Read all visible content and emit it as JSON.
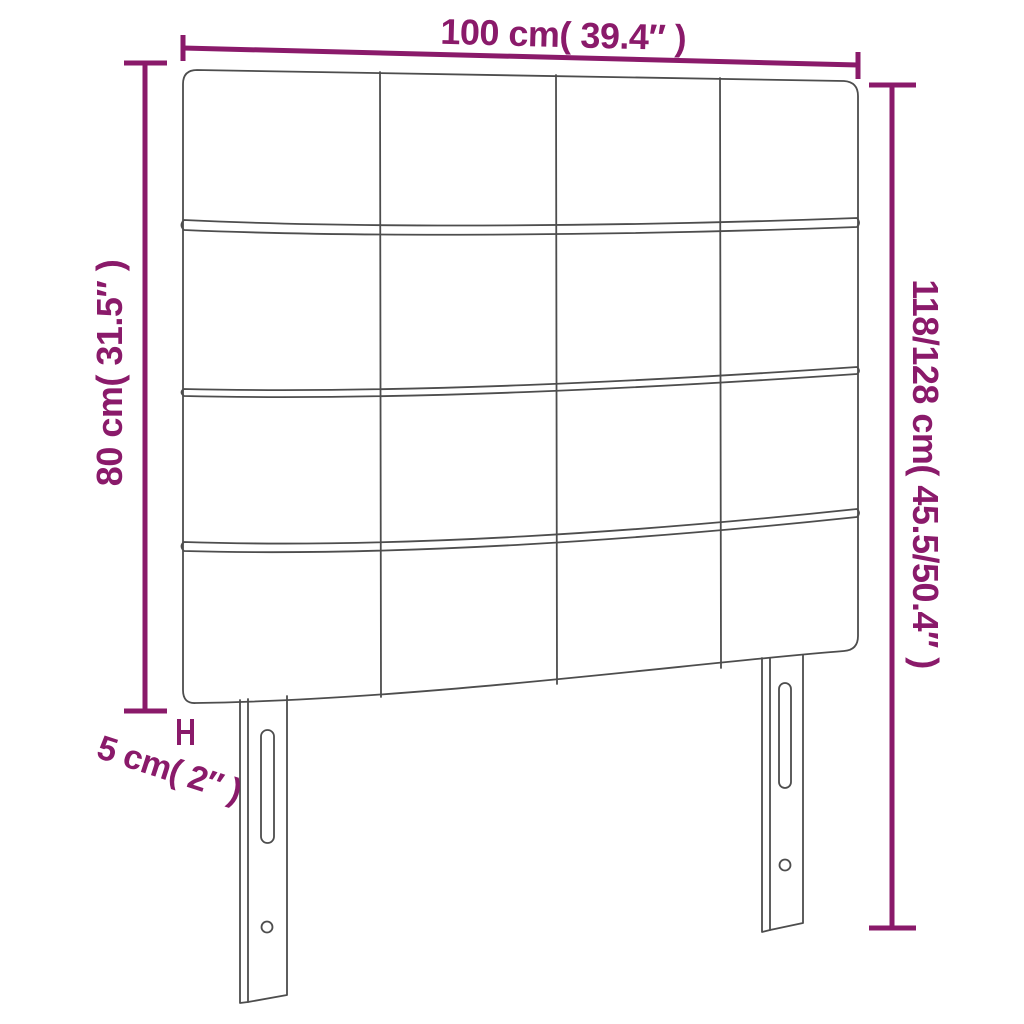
{
  "diagram": {
    "kind": "product-dimension-line-drawing",
    "product": "upholstered panel headboard with two legs",
    "background_color": "#ffffff",
    "accent_color": "#8a1a6a",
    "line_color": "#4d4d4d",
    "panel_grid": {
      "rows": 4,
      "columns": 4
    },
    "legs": {
      "count": 2,
      "features": [
        "vertical-adjustment-slot",
        "screw-hole"
      ]
    },
    "dimensions": {
      "width": {
        "label": "100 cm( 39.4″ )",
        "cm": "100",
        "inch": "39.4"
      },
      "panel_height": {
        "label": "80 cm( 31.5″ )",
        "cm": "80",
        "inch": "31.5"
      },
      "total_height": {
        "label": "118/128 cm( 45.5/50.4″ )",
        "cm": "118/128",
        "inch": "45.5/50.4"
      },
      "thickness": {
        "label": "5 cm( 2″ )",
        "cm": "5",
        "inch": "2"
      }
    }
  }
}
